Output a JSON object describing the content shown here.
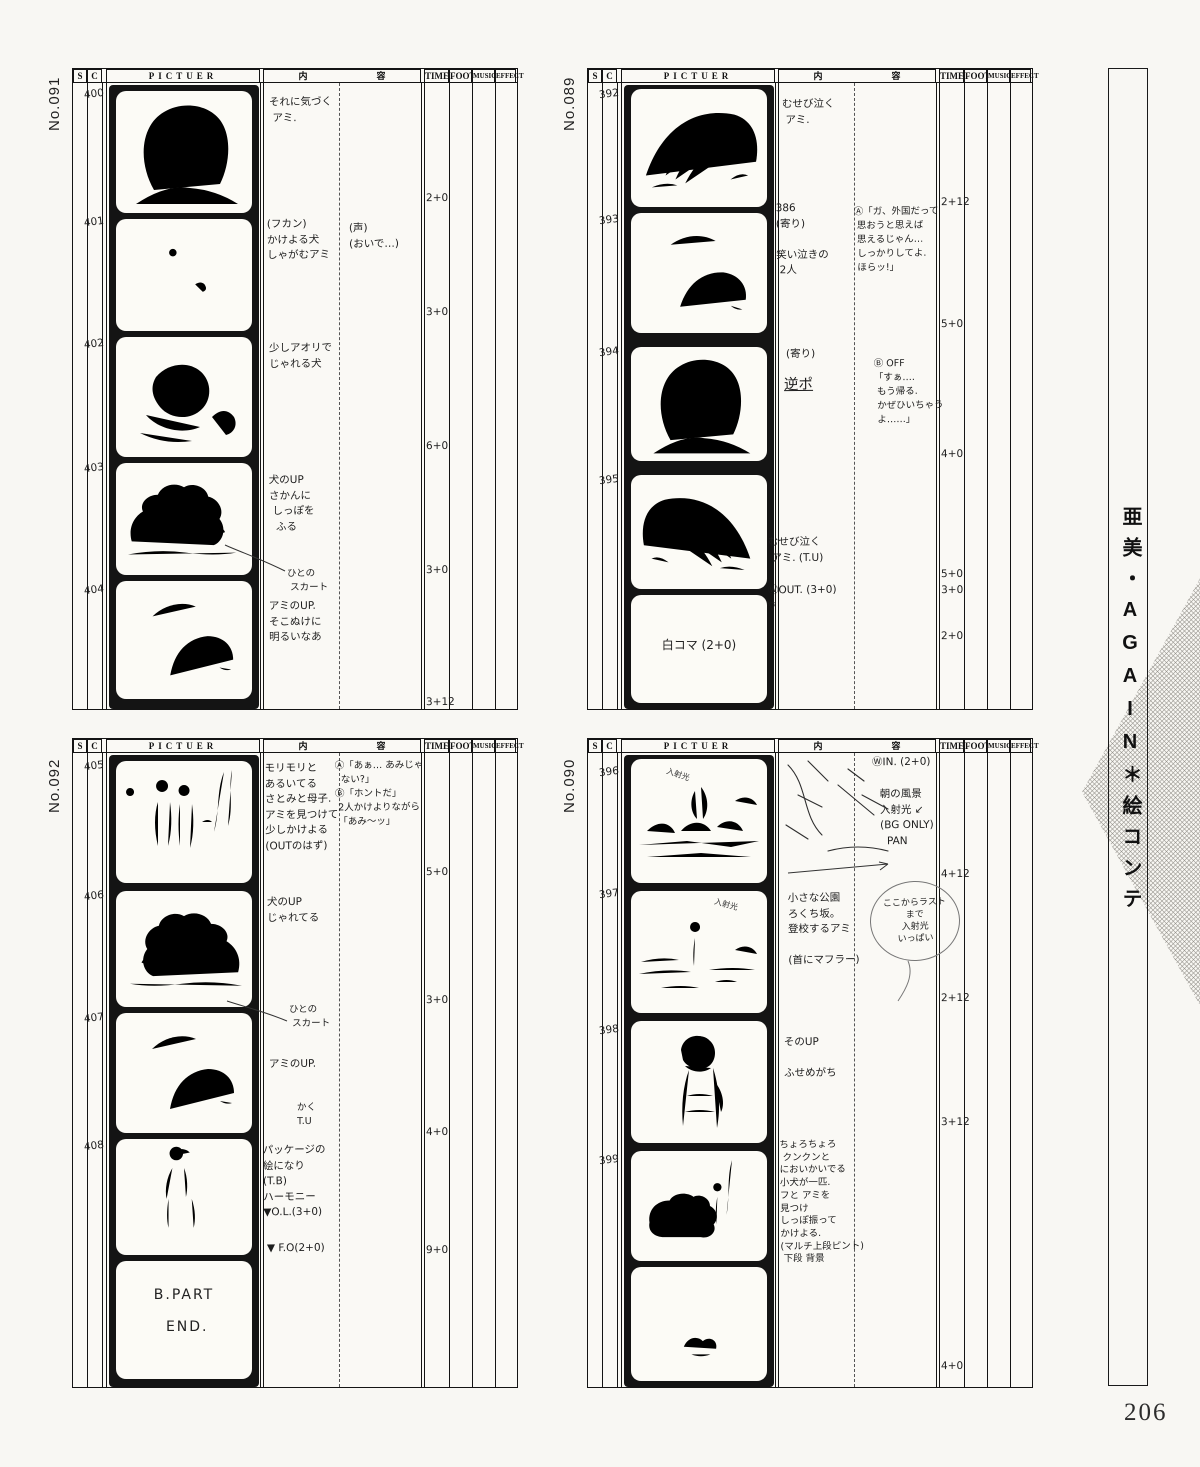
{
  "page_number": "206",
  "sidebar_title": "亜美・AGAIN＊絵コンテ",
  "headers": {
    "s": "S",
    "c": "C",
    "picture": "PICTUER",
    "content_left": "内",
    "content_right": "容",
    "time": "TIME",
    "foot": "FOOT",
    "music": "MUSIC",
    "effect": "EFFECT"
  },
  "boards": [
    {
      "number": "No.091",
      "cuts": [
        {
          "no": "400",
          "action": "それに気づく\n アミ.",
          "time": "2+0"
        },
        {
          "no": "401",
          "action": "(フカン)\nかけよる犬\nしゃがむアミ",
          "dialogue": "(声)\n(おいで…)",
          "time": "3+0"
        },
        {
          "no": "402",
          "action": "少しアオリで\nじゃれる犬",
          "time": "6+0"
        },
        {
          "no": "403",
          "action": "犬のUP\nさかんに\n しっぽを\n  ふる",
          "note": "ひとの\n スカート",
          "time": "3+0"
        },
        {
          "no": "404",
          "action": "アミのUP.\nそこぬけに\n明るいなあ",
          "time": "3+12"
        }
      ]
    },
    {
      "number": "No.089",
      "cuts": [
        {
          "no": "392",
          "action": "むせび泣く\n アミ.",
          "time": "2+12"
        },
        {
          "no": "393",
          "action": "386\n(寄り)\n\n笑い泣きの\n 2人",
          "dialogue": "Ⓐ「ガ、外国だって\n 思おうと思えば\n 思えるじゃん…\n しっかりしてよ.\n ほらッ!」",
          "time": "5+0"
        },
        {
          "no": "394",
          "action": "(寄り)",
          "action2": "逆ポ",
          "dialogue": "Ⓑ OFF\n「すぁ….\n もう帰る.\n かぜひいちゃう\n よ……」",
          "time": "4+0"
        },
        {
          "no": "395",
          "action": "むせび泣く\n アミ. (T.U)",
          "transition": "ⓌOUT. (3+0)\n▽",
          "time": "5+0\n3+0"
        },
        {
          "no": "",
          "frame_text": "白コマ (2+0)",
          "time": "2+0"
        }
      ]
    },
    {
      "number": "No.092",
      "cuts": [
        {
          "no": "405",
          "action": "モリモリと\nあるいてる\nさとみと母子.\nアミを見つけて\n少しかけよる\n(OUTのはず)",
          "dialogue": "Ⓐ「あぁ… あみじゃ\n  ない?」\nⒷ「ホントだ」\n 2人かけよりながら\n 「あみ〜ッ」",
          "time": "5+0"
        },
        {
          "no": "406",
          "action": "犬のUP\nじゃれてる",
          "time": "3+0"
        },
        {
          "no": "407",
          "action": "アミのUP.",
          "note": "ひとの\n スカート",
          "note2": "かく\nT.U",
          "time": "4+0"
        },
        {
          "no": "408",
          "action": "パッケージの\n絵になり\n(T.B)\nハーモニー\n▼O.L.(3+0)",
          "transition": "▼ F.O(2+0)",
          "time": "9+0"
        },
        {
          "no": "",
          "frame_text": "B.PART\n\n END."
        }
      ]
    },
    {
      "number": "No.090",
      "cuts": [
        {
          "no": "396",
          "note_top": "ⓌIN. (2+0)",
          "action": "朝の風景\n入射光 ↙\n(BG ONLY)\n  PAN",
          "sketch_label": "入射光",
          "time": "4+12"
        },
        {
          "no": "397",
          "action": "小さな公園\nろくち坂。\n登校するアミ\n\n(首にマフラー)",
          "note": "ここからラスト\nまで\n入射光\nいっぱい",
          "sketch_label": "入射光",
          "time": "2+12"
        },
        {
          "no": "398",
          "action": "そのUP\n\nふせめがち",
          "time": "3+12"
        },
        {
          "no": "399",
          "action": "ちょろちょろ\n クンクンと\nにおいかいでる\n小犬が一匹.\nフと アミを\n見つけ\nしっぽ振って\nかけよる.\n(マルチ上段ピント)\n 下段 背景",
          "time": "4+0"
        },
        {
          "no": ""
        }
      ]
    }
  ]
}
